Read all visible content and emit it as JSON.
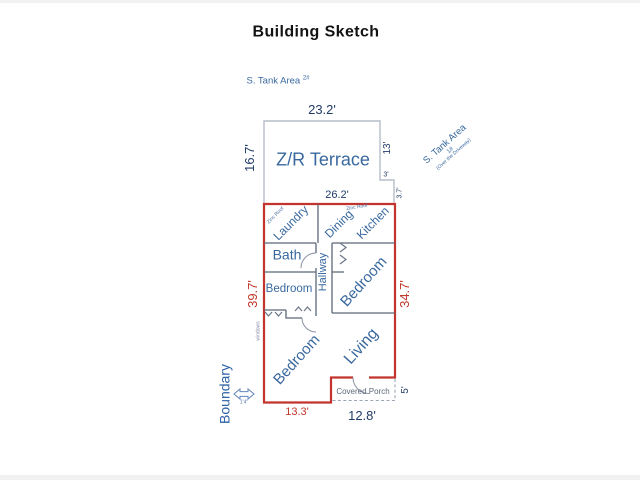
{
  "page": {
    "title": "Building Sketch"
  },
  "annotations": {
    "tank_area_2": "S. Tank Area",
    "tank_area_2_num": "2#",
    "tank_area_1": "S. Tank Area",
    "tank_area_1_num": "1#",
    "tank_area_1_sub": "(Over the Driveway)",
    "zinc_roof": "Zinc Roof",
    "windows": "windows",
    "boundary": "Boundary",
    "boundary_offset": "1'4\"",
    "boundary_arrow_icon": "double-headed-horizontal-arrow"
  },
  "rooms": {
    "terrace": "Z/R Terrace",
    "laundry": "Laundry",
    "dining": "Dining",
    "kitchen": "Kitchen",
    "bath": "Bath",
    "hallway": "Hallway",
    "bedroom_small": "Bedroom",
    "bedroom_right": "Bedroom",
    "bedroom_bottom": "Bedroom",
    "living": "Living",
    "covered_porch": "Covered Porch"
  },
  "dimensions": {
    "terrace_width": "23.2'",
    "terrace_height": "16.7'",
    "terrace_right": "13'",
    "step_width": "3'",
    "step_height": "3.7'",
    "building_width": "26.2'",
    "building_left": "39.7'",
    "building_right": "34.7'",
    "porch_height": "5'",
    "bottom_left": "13.3'",
    "bottom_right": "12.8'"
  },
  "colors": {
    "room_label_blue": "#38689e",
    "dimension_navy": "#223c68",
    "dimension_red": "#c0392b",
    "building_outline_red": "#c4342e",
    "interior_wall_gray": "#5c6878",
    "terrace_outline_gray": "#b6bdc9"
  }
}
